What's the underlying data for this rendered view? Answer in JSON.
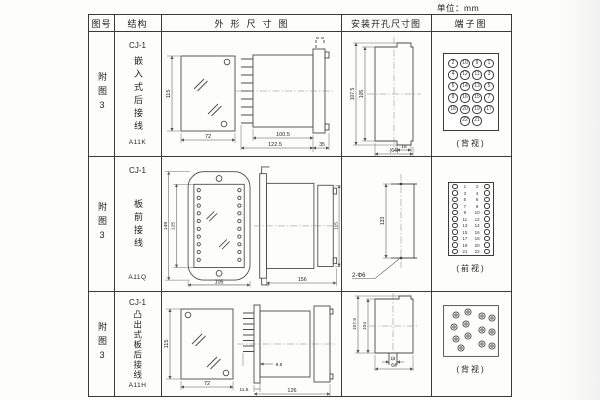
{
  "unit_label": "单位：mm",
  "headers": {
    "fig_no": "图号",
    "structure": "结构",
    "outline": "外形尺寸图",
    "mounting": "安装开孔尺寸图",
    "terminal": "端子图"
  },
  "rows": [
    {
      "fig_no": "附图3",
      "model": "CJ-1",
      "mount_type": "嵌入式后接线",
      "code": "A11K",
      "outline": {
        "front_h": "115",
        "front_w": "72",
        "body_len": "100.5",
        "total_len": "122.5",
        "flange_w": "35"
      },
      "mounting": {
        "outer_h": "107.5",
        "inner_h": "105",
        "tab_w": "16",
        "total_w": "(64)"
      },
      "terminal": {
        "view_label": "(背视)",
        "circle_rows": [
          [
            "2",
            "10",
            "9",
            "1"
          ],
          [
            "4",
            "12",
            "11",
            "3"
          ],
          [
            "6",
            "14",
            "13",
            "5"
          ],
          [
            "8",
            "16",
            "15",
            "7"
          ],
          [
            "18",
            "20",
            "19",
            "17"
          ],
          [
            "22",
            "21"
          ]
        ]
      }
    },
    {
      "fig_no": "附图3",
      "model": "CJ-1",
      "mount_type": "板前接线",
      "code": "A11Q",
      "outline": {
        "outer_h": "149",
        "inner_h": "125",
        "front_w": "105",
        "side_len": "156",
        "side_h": "115",
        "pin_dots": [
          [
            39,
            33
          ],
          [
            39,
            41
          ],
          [
            39,
            49
          ],
          [
            39,
            57
          ],
          [
            39,
            65
          ],
          [
            39,
            73
          ],
          [
            39,
            81
          ],
          [
            39,
            89
          ],
          [
            39,
            97
          ],
          [
            39,
            105
          ],
          [
            81,
            33
          ],
          [
            81,
            41
          ],
          [
            81,
            49
          ],
          [
            81,
            57
          ],
          [
            81,
            65
          ],
          [
            81,
            73
          ],
          [
            81,
            81
          ],
          [
            81,
            89
          ],
          [
            81,
            97
          ],
          [
            81,
            105
          ]
        ]
      },
      "mounting": {
        "hole_spacing": "133",
        "hole_label": "2-Φ6"
      },
      "terminal": {
        "view_label": "(前视)",
        "pairs": [
          [
            "1",
            "2"
          ],
          [
            "3",
            "4"
          ],
          [
            "5",
            "6"
          ],
          [
            "7",
            "8"
          ],
          [
            "9",
            "10"
          ],
          [
            "11",
            "12"
          ],
          [
            "13",
            "14"
          ],
          [
            "15",
            "16"
          ],
          [
            "17",
            "18"
          ],
          [
            "19",
            "20"
          ],
          [
            "21",
            "22"
          ]
        ]
      }
    },
    {
      "fig_no": "附图3",
      "model": "CJ-1",
      "mount_type": "凸出式板后接线",
      "code": "A11H",
      "outline": {
        "front_h": "115",
        "front_w": "72",
        "plate_t": "11.5",
        "pin_len": "9.5",
        "total_len": "126"
      },
      "mounting": {
        "outer_h": "107.5",
        "inner_h": "104",
        "slot_w": "14",
        "total_w": "64"
      },
      "terminal": {
        "view_label": "(背视)",
        "dots": [
          [
            13,
            10
          ],
          [
            25,
            7
          ],
          [
            11,
            22
          ],
          [
            23,
            19
          ],
          [
            13,
            34
          ],
          [
            25,
            31
          ],
          [
            18,
            43
          ],
          [
            39,
            11
          ],
          [
            49,
            13
          ],
          [
            39,
            25
          ],
          [
            49,
            27
          ],
          [
            39,
            39
          ],
          [
            49,
            41
          ]
        ]
      }
    }
  ]
}
